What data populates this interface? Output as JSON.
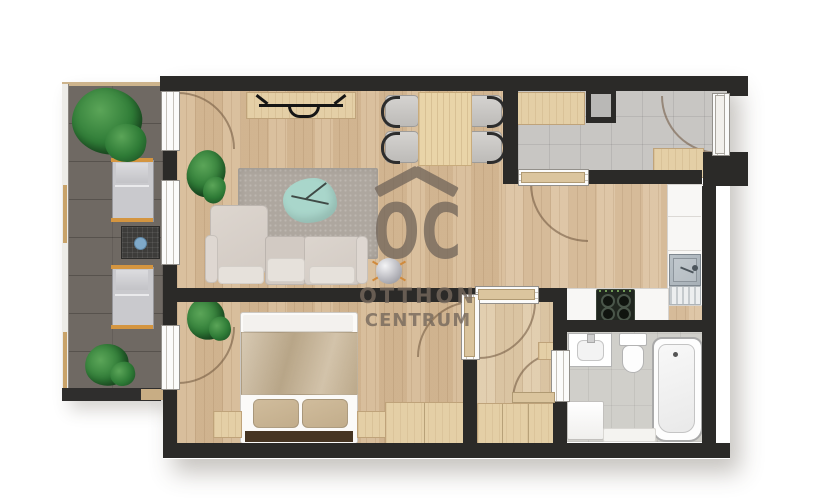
{
  "watermark": {
    "logo": "OC",
    "roof_symbol": "^",
    "tagline_line1": "OTTHON",
    "tagline_line2": "CENTRUM"
  },
  "colors": {
    "wall": "#2b2a28",
    "living_floor": "#d7bb97",
    "kitchen_floor": "#dcc2a0",
    "bedroom_floor": "#d5b995",
    "hall_floor": "#e0cbaa",
    "entry_floor": "#c8c6c3",
    "bath_floor": "#d0cfca",
    "deck": "#6f6963",
    "rug": "#aea79f",
    "sofa_back": "#d2cac3",
    "sofa_cushion": "#e6e1db",
    "coffee_table": "#a9d6cb",
    "furniture_wood": "#e4cfa6",
    "counter": "#f8f7f5",
    "steel": "#a7b0b7",
    "cooktop": "#20261f",
    "blanket": "#c6b292",
    "pillow": "#c2ad8b",
    "headboard": "#463523",
    "plant": "#2e7b36",
    "lounger_cushion": "#c9c9cd",
    "lounger_frame": "#d49540",
    "leaf_wood": "#dbc59e",
    "arc": "rgba(110,84,60,0.55)",
    "watermark": "#76695d",
    "cup_blue": "#7fa9c9"
  },
  "plan": {
    "rooms": [
      {
        "name": "balcony",
        "items": [
          "plant",
          "plant",
          "sun-lounger",
          "sun-lounger",
          "side-table"
        ]
      },
      {
        "name": "living-dining-room",
        "items": [
          "tv-console",
          "tv",
          "dining-table",
          "dining-chair",
          "dining-chair",
          "dining-chair",
          "dining-chair",
          "rug",
          "coffee-table",
          "corner-sofa",
          "floor-lamp",
          "plant"
        ]
      },
      {
        "name": "kitchen",
        "items": [
          "counter",
          "kitchen-sink",
          "cooktop"
        ]
      },
      {
        "name": "entry-hall",
        "items": [
          "front-door",
          "bench-cabinet",
          "cabinet",
          "utility-shaft"
        ]
      },
      {
        "name": "inner-hall",
        "items": [
          "wardrobe",
          "shelf"
        ]
      },
      {
        "name": "bedroom",
        "items": [
          "double-bed",
          "pillow",
          "pillow",
          "nightstand",
          "nightstand",
          "wardrobe",
          "plant"
        ]
      },
      {
        "name": "bathroom",
        "items": [
          "bathtub",
          "toilet",
          "washbasin",
          "washing-machine",
          "bath-mat"
        ]
      }
    ]
  }
}
